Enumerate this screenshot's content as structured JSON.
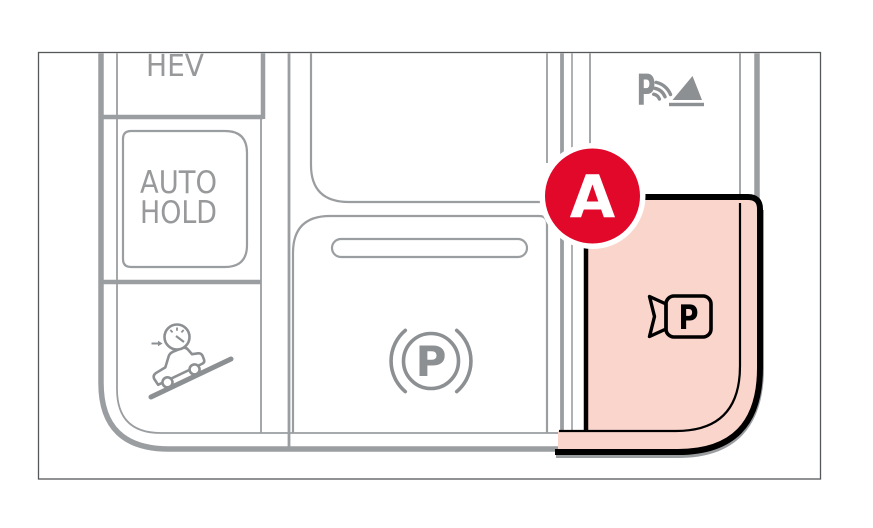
{
  "buttons": {
    "hev": {
      "label": "HEV"
    },
    "auto_hold": {
      "line1": "AUTO",
      "line2": "HOLD"
    },
    "downhill_brake": {
      "icon": "car-on-downhill-with-speedometer-icon"
    },
    "parking_brake": {
      "icon": "parking-brake-p-with-arcs-icon",
      "letter": "P"
    },
    "parking_distance": {
      "icon": "p-with-sound-waves-and-triangle-icon",
      "letter": "P"
    },
    "remote_parking": {
      "icon": "p-in-camera-outline-icon",
      "letter": "P",
      "highlighted": true
    }
  },
  "callout": {
    "label": "A"
  },
  "colors": {
    "highlight_fill": "#fad5cc",
    "highlight_outline": "#000000",
    "callout_red": "#e1082a",
    "panel_line_gray": "#9b9ea1",
    "icon_gray": "#8d9093",
    "label_gray": "#97999b"
  }
}
